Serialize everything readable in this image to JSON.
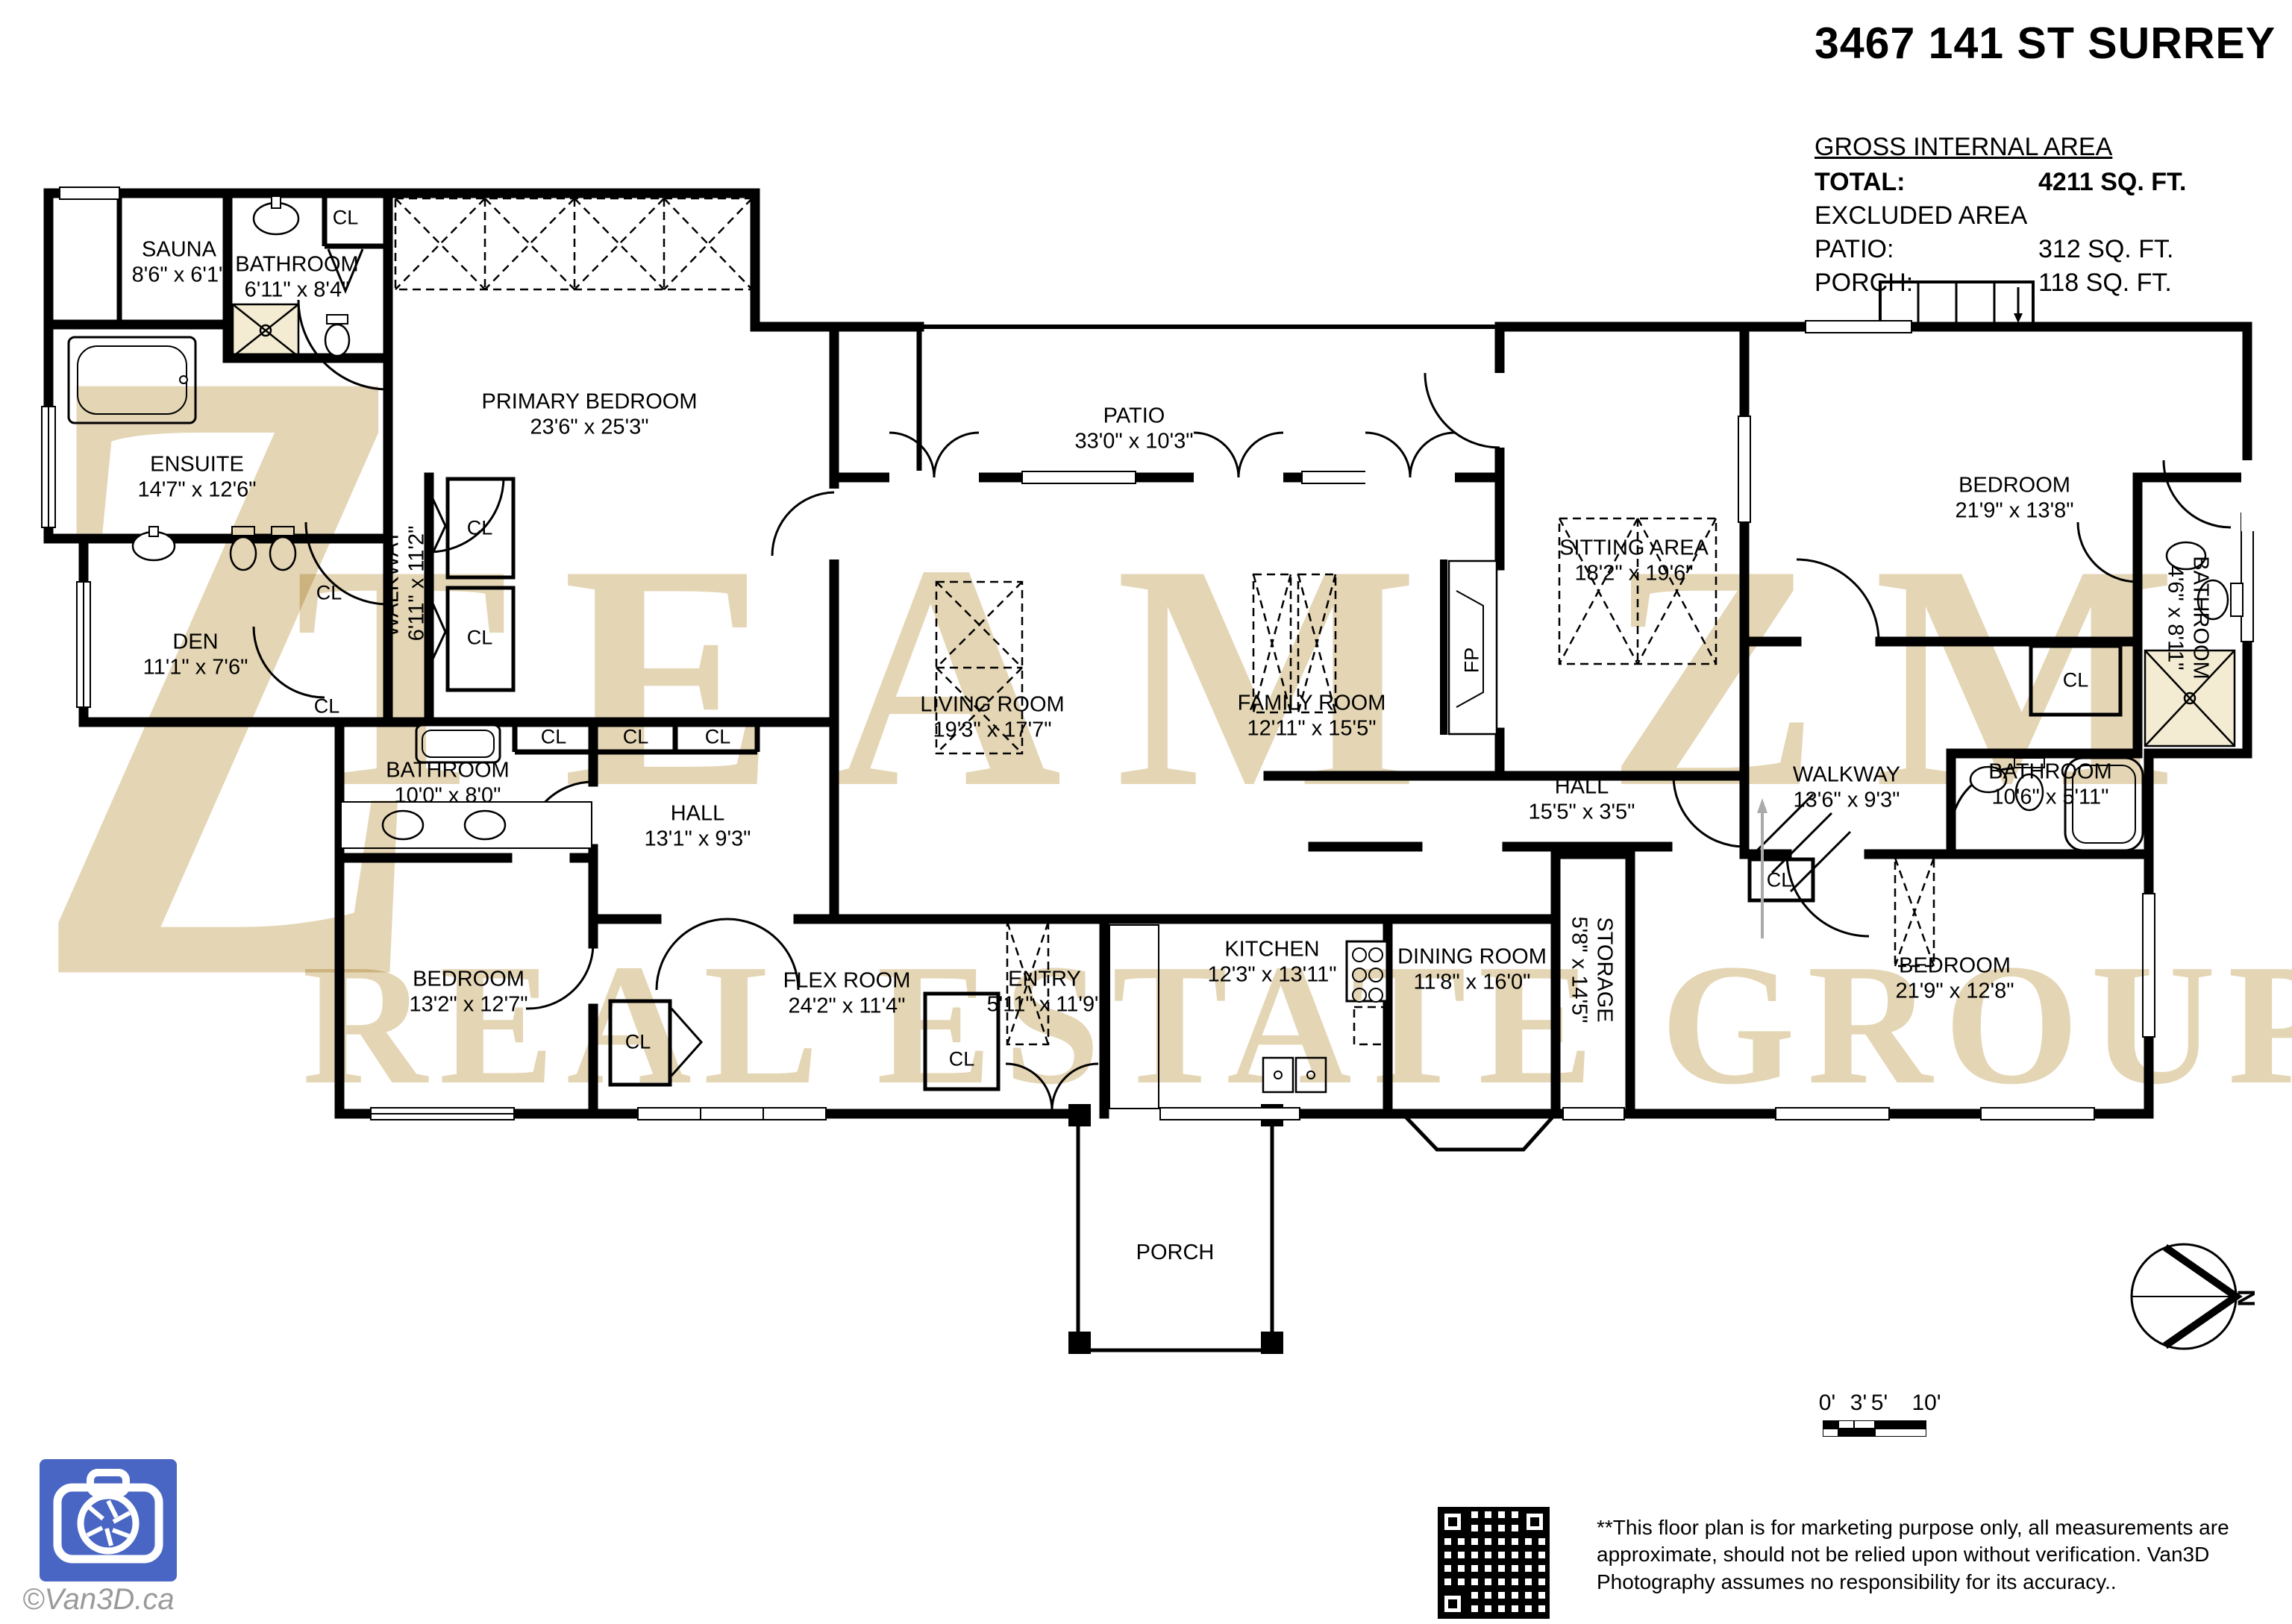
{
  "title": "3467 141 ST SURREY",
  "area": {
    "heading": "GROSS INTERNAL AREA",
    "rows": [
      {
        "label": "TOTAL:",
        "value": "4211 SQ. FT."
      },
      {
        "label": "EXCLUDED AREA",
        "value": ""
      },
      {
        "label": "PATIO:",
        "value": "312 SQ. FT."
      },
      {
        "label": "PORCH:",
        "value": "118 SQ. FT."
      }
    ]
  },
  "labels": {
    "cl": "CL",
    "fp": "FP"
  },
  "compass": {
    "north": "N"
  },
  "watermark": {
    "monogram": "Z",
    "line1": "TEAM ZM",
    "line2": "REAL ESTATE GROUP"
  },
  "rooms": [
    {
      "name": "SAUNA",
      "dims": "8'6\" x 6'1\""
    },
    {
      "name": "BATHROOM",
      "dims": "6'11\" x 8'4\""
    },
    {
      "name": "ENSUITE",
      "dims": "14'7\" x 12'6\""
    },
    {
      "name": "DEN",
      "dims": "11'1\" x 7'6\""
    },
    {
      "name": "WALKWAY",
      "dims": "6'11\" x 11'2\""
    },
    {
      "name": "PRIMARY BEDROOM",
      "dims": "23'6\" x 25'3\""
    },
    {
      "name": "PATIO",
      "dims": "33'0\" x 10'3\""
    },
    {
      "name": "LIVING ROOM",
      "dims": "19'3\" x 17'7\""
    },
    {
      "name": "FAMILY ROOM",
      "dims": "12'11\" x 15'5\""
    },
    {
      "name": "SITTING AREA",
      "dims": "18'2\" x 19'6\""
    },
    {
      "name": "HALL",
      "dims": "15'5\" x 3'5\""
    },
    {
      "name": "BEDROOM",
      "dims": "21'9\" x 13'8\""
    },
    {
      "name": "BATHROOM",
      "dims": "4'6\" x 8'11\""
    },
    {
      "name": "WALKWAY",
      "dims": "13'6\" x 9'3\""
    },
    {
      "name": "BATHROOM",
      "dims": "10'6\" x 5'11\""
    },
    {
      "name": "BEDROOM",
      "dims": "21'9\" x 12'8\""
    },
    {
      "name": "STORAGE",
      "dims": "5'8\" x 14'5\""
    },
    {
      "name": "BATHROOM",
      "dims": "10'0\" x 8'0\""
    },
    {
      "name": "HALL",
      "dims": "13'1\" x 9'3\""
    },
    {
      "name": "BEDROOM",
      "dims": "13'2\" x 12'7\""
    },
    {
      "name": "FLEX ROOM",
      "dims": "24'2\" x 11'4\""
    },
    {
      "name": "ENTRY",
      "dims": "5'11\" x 11'9\""
    },
    {
      "name": "KITCHEN",
      "dims": "12'3\" x 13'11\""
    },
    {
      "name": "DINING ROOM",
      "dims": "11'8\" x 16'0\""
    },
    {
      "name": "PORCH",
      "dims": ""
    }
  ],
  "scale": {
    "ticks": [
      "0'",
      "3'",
      "5'",
      "10'"
    ]
  },
  "disclaimer": "**This floor plan is for marketing purpose only, all measurements are approximate, should not be relied upon without verification. Van3D Photography assumes no responsibility for its accuracy..",
  "credit": "©Van3D.ca"
}
